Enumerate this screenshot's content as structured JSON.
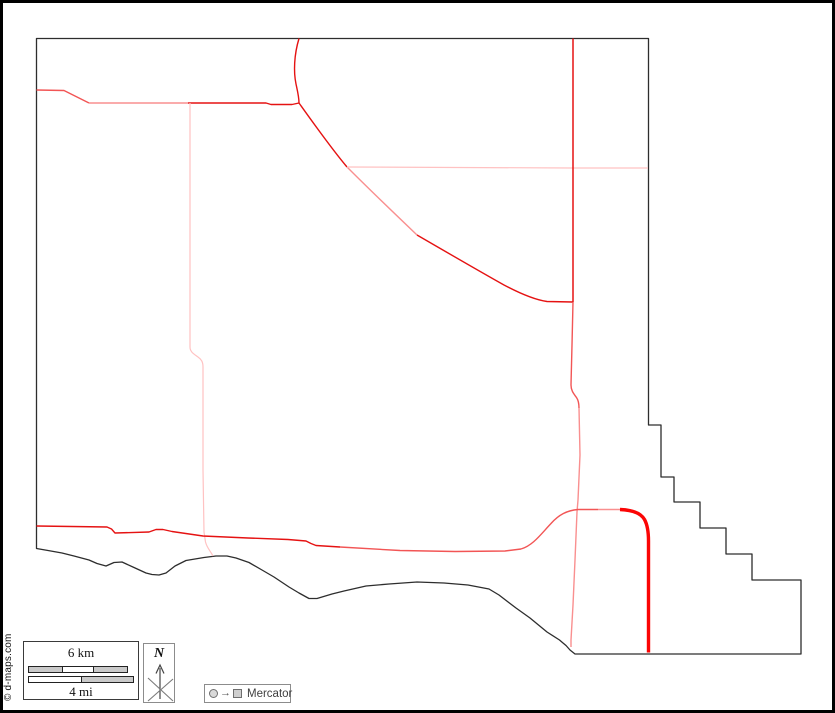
{
  "copyright": "© d-maps.com",
  "scale": {
    "km_label": "6 km",
    "mi_label": "4 mi"
  },
  "north": {
    "label": "N"
  },
  "projection": {
    "label": "Mercator",
    "arrow_glyph": "→"
  },
  "colors": {
    "outline": "#2d2d2d",
    "main_red": "#e51212",
    "med_red": "#f25555",
    "light_red": "#f98f8f",
    "pale_pink": "#ffc2c2",
    "highway": "#fb0505"
  },
  "map": {
    "outline": {
      "name": "county-boundary",
      "color": "outline",
      "w": 1.3,
      "d": "M 36.5 38.5 L 648.5 38.5 L 648.5 425 L 661 425 L 661 477 L 674 477 L 674 502 L 700 502 L 700 528 L 726 528 L 726 554 L 752 554 L 752 580 L 801 580 L 801 654 L 575 654 L 570 650 L 566 645.5 L 563 643 L 559.5 640 L 547 632 L 530 618 L 516 608 L 499 595 L 489 589 L 468 585 L 444 583 L 417 582 L 389 584 L 366 586 L 344 591 L 332 594 L 317 598.5 L 309 598.5 L 299 593 L 289 587 L 274 577 L 262 570 L 249 562.5 L 236 558 L 227 556 L 216 556 L 204 557.5 L 186 560.5 L 175 566 L 166 573 L 159 575 L 152 574.5 L 146 573 L 134 567.5 L 122 562 L 114 562.5 L 106 566 L 97 563.5 L 89 560 L 74 556 L 62 553 L 48 550.5 L 36.5 548.5 Z"
    },
    "roads": [
      {
        "name": "road-west-entry",
        "color": "med_red",
        "w": 1.4,
        "d": "M 36.5 90 L 64 90.5 L 89 103"
      },
      {
        "name": "road-west-horizontal-pale",
        "color": "light_red",
        "w": 1.4,
        "d": "M 89 103 L 188 103"
      },
      {
        "name": "road-west-horizontal-red",
        "color": "main_red",
        "w": 1.4,
        "d": "M 188 103 L 266 103 L 271 104.5 L 292 104.5 L 299 103"
      },
      {
        "name": "road-north-connector",
        "color": "main_red",
        "w": 1.4,
        "d": "M 299 38.5 C 294 55 293.5 72 296 84 C 297.5 91 299 97 299 103"
      },
      {
        "name": "road-diagonal-upper",
        "color": "main_red",
        "w": 1.4,
        "d": "M 299 103 C 314 124 331 148 347 167"
      },
      {
        "name": "road-diagonal-mid",
        "color": "light_red",
        "w": 1.4,
        "d": "M 347 167 C 370 190 395 214 417 235"
      },
      {
        "name": "road-diagonal-lower",
        "color": "main_red",
        "w": 1.4,
        "d": "M 417 235 C 448 253 479 271 504 285 C 521 294 536 300 547 301.5 L 573 302"
      },
      {
        "name": "road-east-pale-horizontal",
        "color": "pale_pink",
        "w": 1.2,
        "d": "M 347 167 L 573 168 L 648 168"
      },
      {
        "name": "road-main-vertical-north",
        "color": "main_red",
        "w": 1.5,
        "d": "M 573 38.5 L 573 302"
      },
      {
        "name": "road-main-vertical-mid",
        "color": "med_red",
        "w": 1.4,
        "d": "M 573 302 L 572 345 L 571 385 C 571 391 574 394 576.5 397.5 C 578.5 400.5 579 403 579 408"
      },
      {
        "name": "road-main-vertical-south",
        "color": "light_red",
        "w": 1.4,
        "d": "M 579 408 L 580 455 L 578 500 L 577 512 L 575 560 L 573 605 L 571 640 L 571 647"
      },
      {
        "name": "road-west-pale-vertical-upper",
        "color": "pale_pink",
        "w": 1.2,
        "d": "M 190 103 L 190 347 C 190 352 194 354 198 357 C 201.5 359.5 203 362 203 367"
      },
      {
        "name": "road-west-pale-vertical-lower",
        "color": "pale_pink",
        "w": 1.2,
        "d": "M 203 367 L 203 470 L 204 532 L 205.5 542 C 207 548 210.5 551 213 556"
      },
      {
        "name": "road-south-highway-west",
        "color": "main_red",
        "w": 1.4,
        "d": "M 36.5 526 L 107 527 L 111.5 529 L 115 533 L 149 532 L 156 529.5 L 163 529.5 L 172 531.5 L 203 536 L 248 538 L 288 539.5 L 306 541 L 311 543.5 L 316 545.5 L 340 547"
      },
      {
        "name": "road-south-highway-mid",
        "color": "med_red",
        "w": 1.4,
        "d": "M 340 547 L 400 550.5 L 455 551.5 L 505 551 L 521 549"
      },
      {
        "name": "road-south-curve-up",
        "color": "med_red",
        "w": 1.4,
        "d": "M 521 549 C 533 545.5 541 534 551 523.5 C 559 514.5 567 510.5 578 509.5 L 598 509.5"
      },
      {
        "name": "road-south-pale-link",
        "color": "light_red",
        "w": 1.4,
        "d": "M 598 509.5 L 620 509.5"
      },
      {
        "name": "highway-thick",
        "color": "highway",
        "w": 3.4,
        "d": "M 620 509.5 C 634 510 641 513.5 644.5 519.5 C 647.5 525 648.5 532 648.5 541 L 648.5 652.5"
      }
    ]
  }
}
